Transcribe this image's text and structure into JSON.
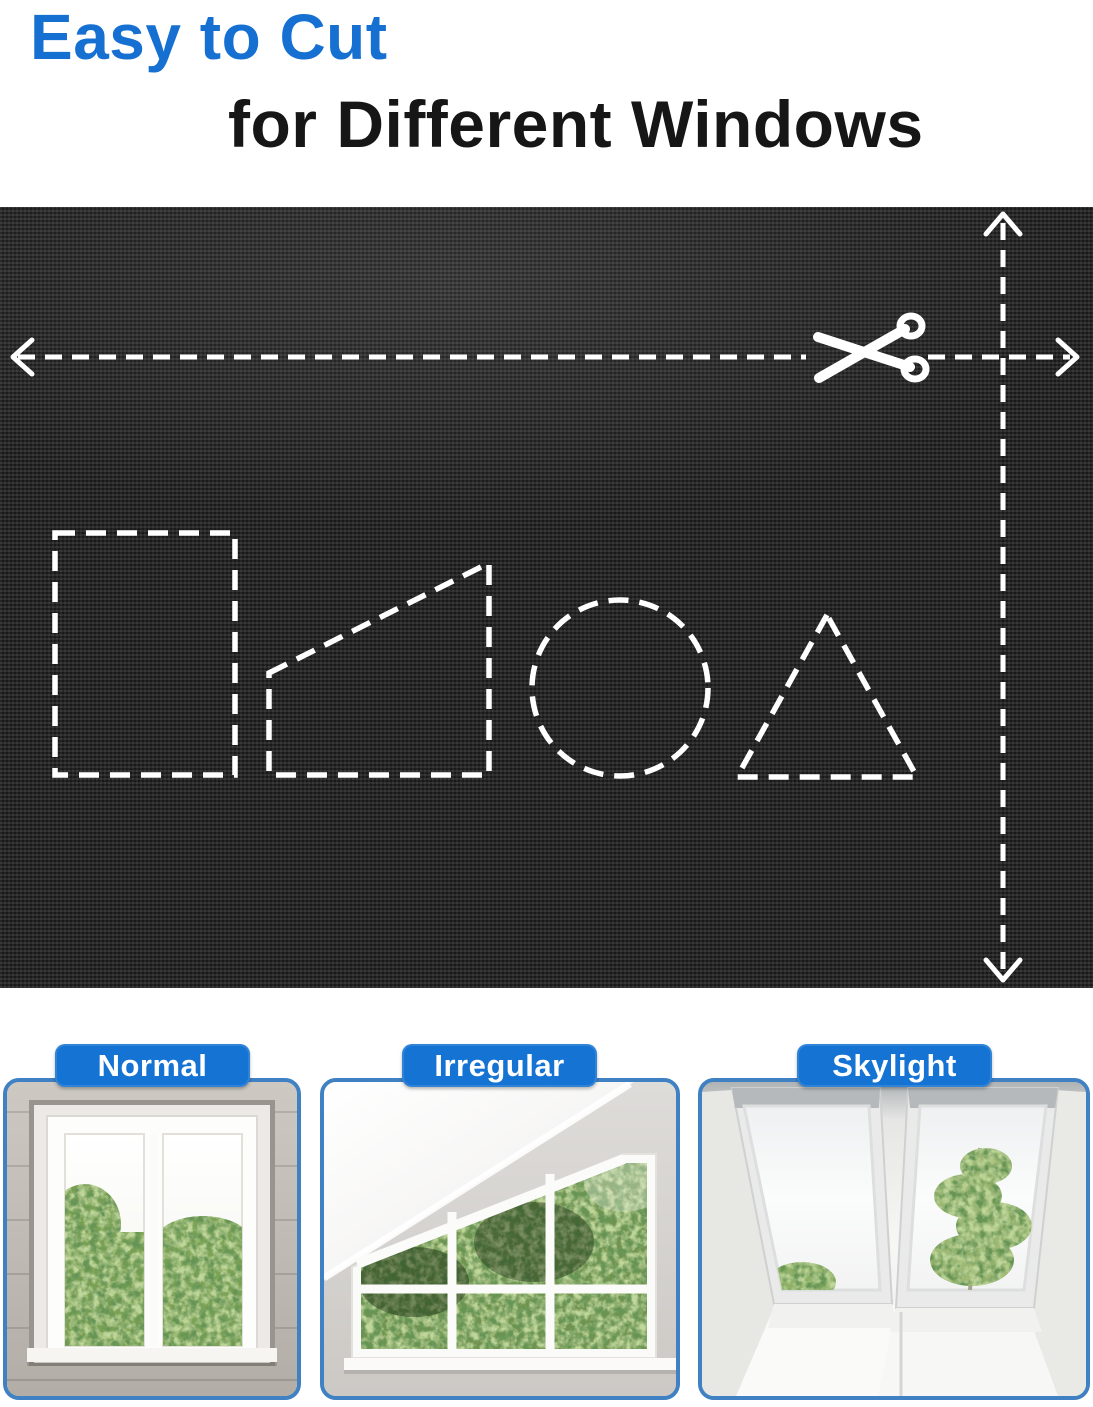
{
  "title": {
    "line1": "Easy to Cut",
    "line2": "for Different Windows"
  },
  "fabric_panel": {
    "description": "black blackout fabric with dashed white cutting guides",
    "icons": [
      "scissors-icon",
      "left-arrow-icon",
      "right-arrow-icon",
      "up-arrow-icon",
      "down-arrow-icon"
    ],
    "cut_guides": [
      "horizontal-cut-line",
      "vertical-cut-line"
    ],
    "shape_templates": [
      "rectangle",
      "slanted-trapezoid",
      "circle",
      "triangle"
    ]
  },
  "cards": [
    {
      "label": "Normal",
      "photo": "normal-window-photo"
    },
    {
      "label": "Irregular",
      "photo": "irregular-window-photo"
    },
    {
      "label": "Skylight",
      "photo": "skylight-window-photo"
    }
  ],
  "colors": {
    "title_blue": "#1670d2",
    "title_dark": "#161616",
    "fabric_base": "#242424",
    "guide_white": "#ffffff",
    "pill_blue": "#1473d3",
    "pill_text": "#ffffff",
    "card_border_blue": "#3f81c3"
  }
}
